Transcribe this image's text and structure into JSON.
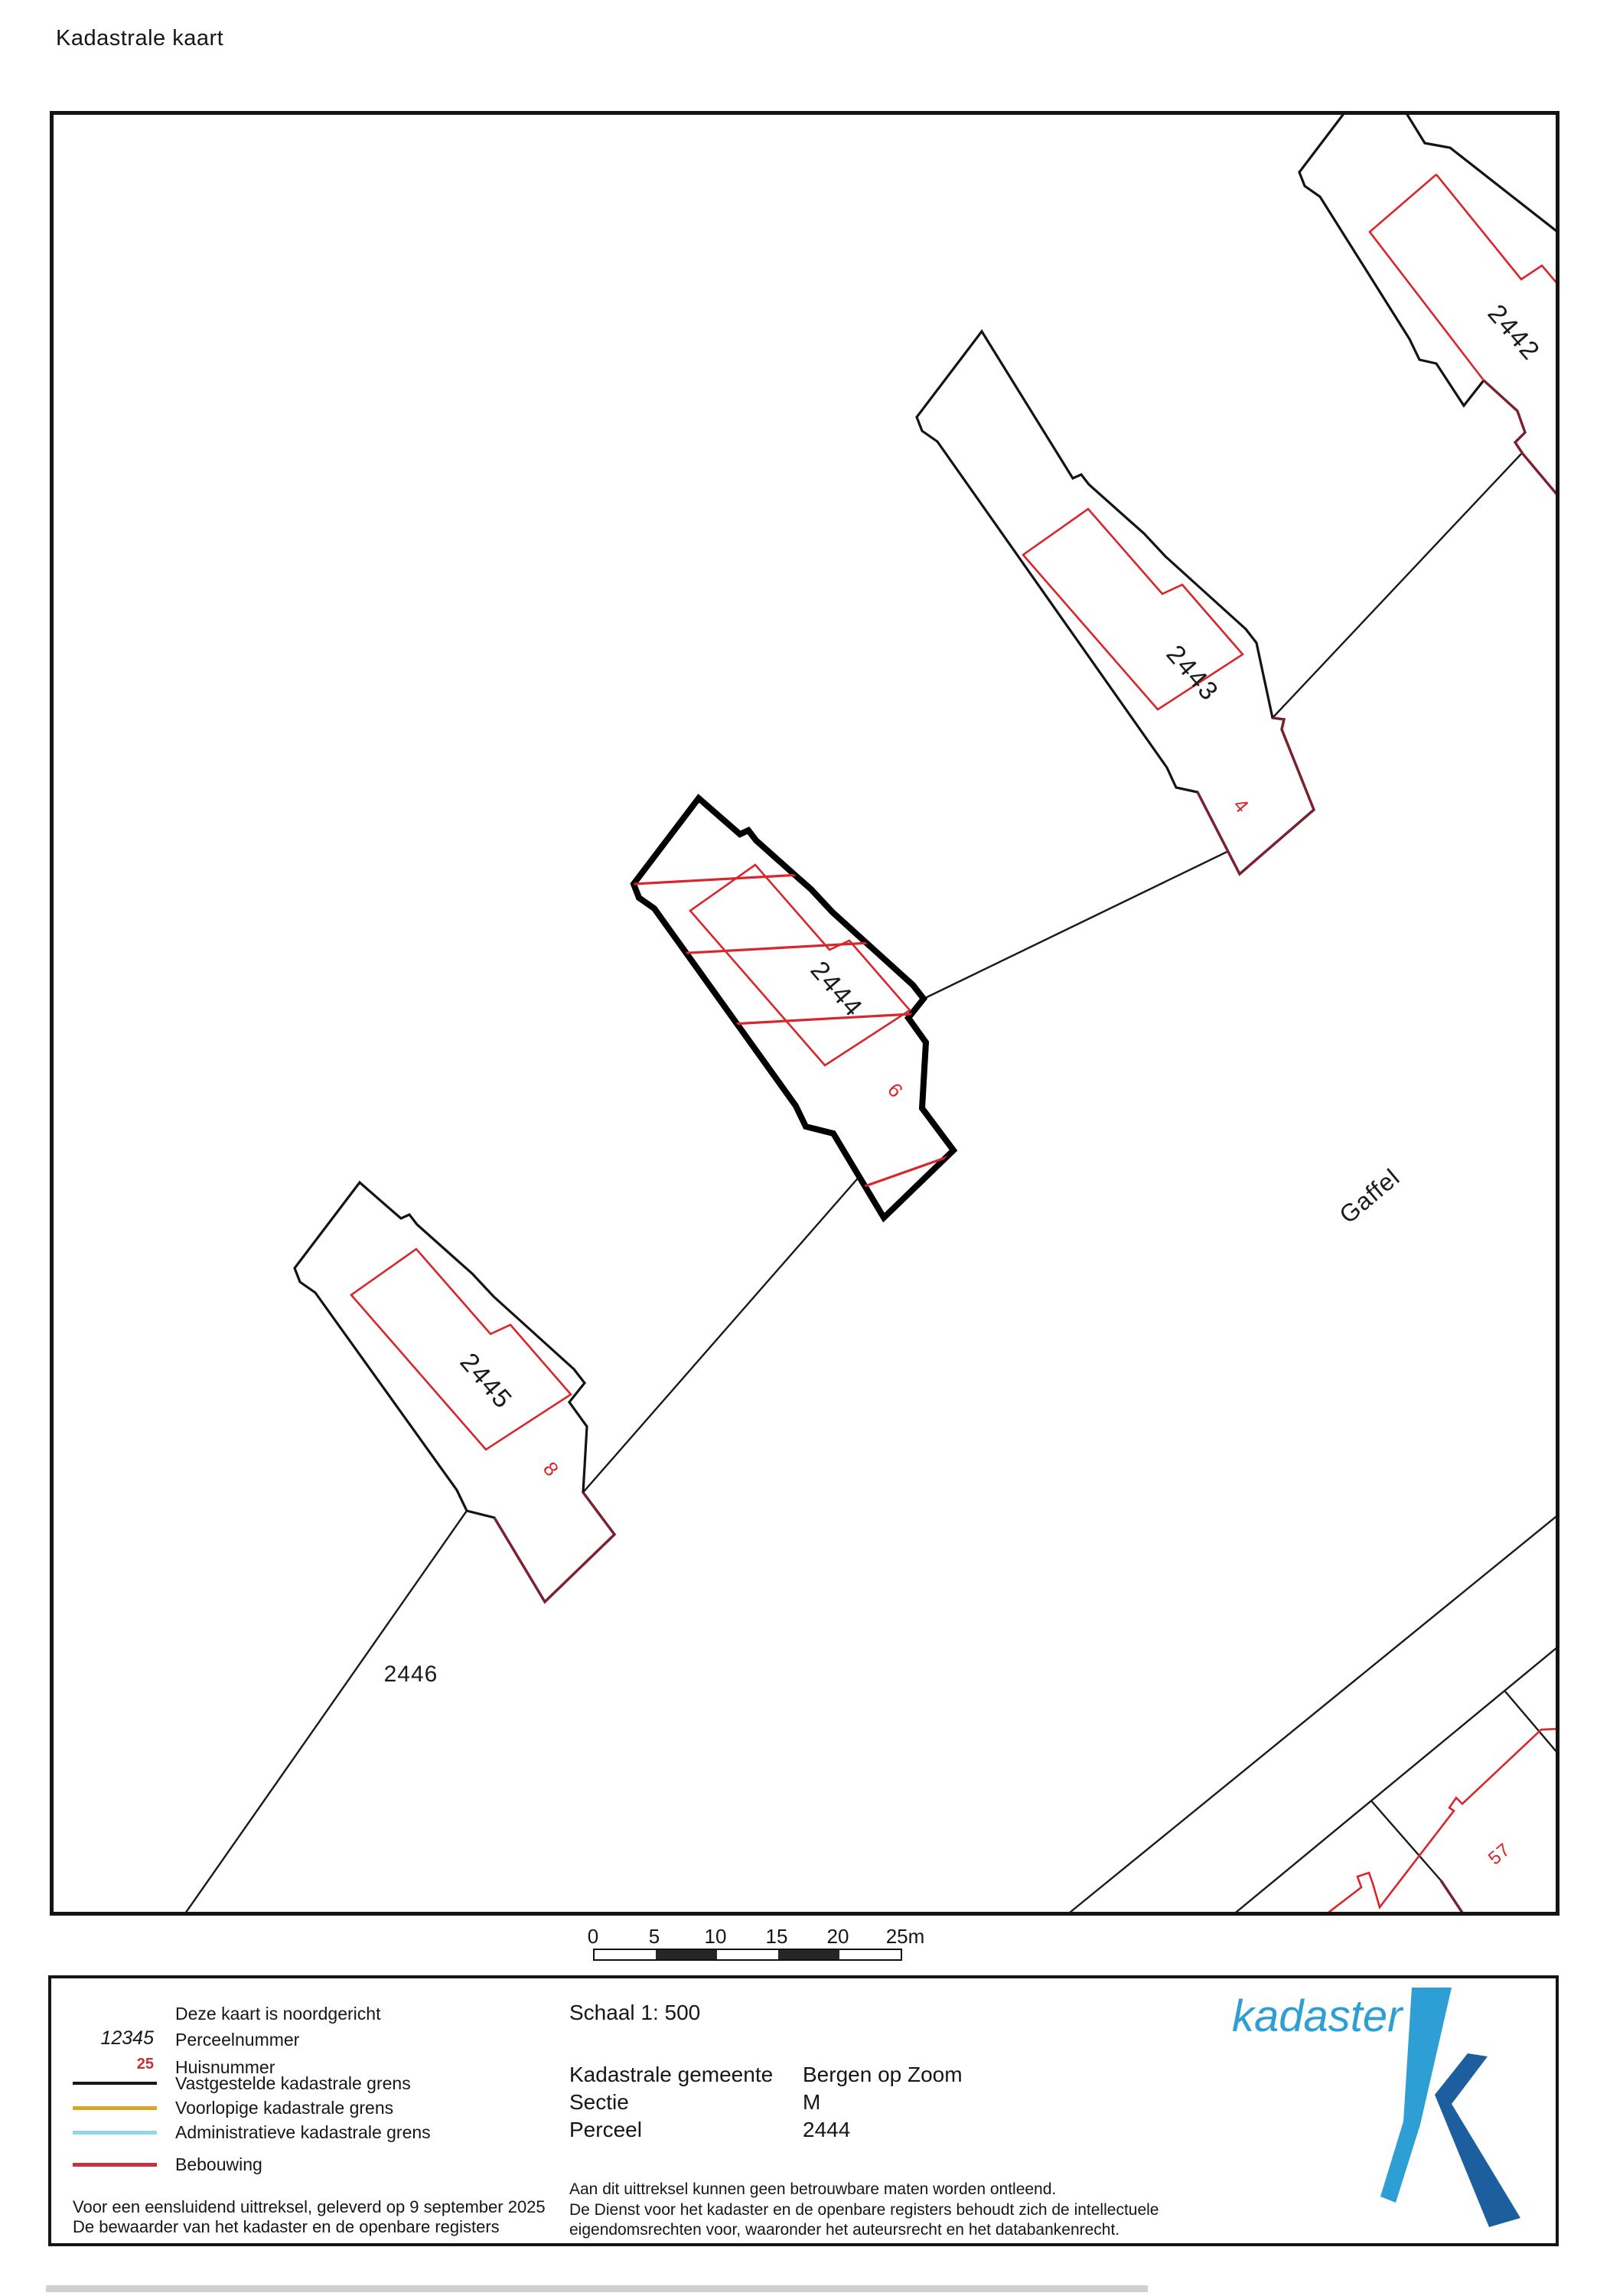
{
  "title": "Kadastrale kaart",
  "map": {
    "parcel_numbers": {
      "p2442": "2442",
      "p2443": "2443",
      "p2444": "2444",
      "p2445": "2445",
      "p2446": "2446"
    },
    "house_numbers": {
      "h4": "4",
      "h6": "6",
      "h8": "8",
      "h57": "57"
    },
    "street": "Gaffel",
    "selected_parcel": "2444",
    "colors": {
      "boundary": "#161616",
      "building": "#d8262c",
      "building_overlap": "#7c2130"
    }
  },
  "scalebar": {
    "ticks": [
      "0",
      "5",
      "10",
      "15",
      "20",
      "25m"
    ]
  },
  "footer": {
    "north_note": "Deze kaart is noordgericht",
    "legend": {
      "items": [
        {
          "symbol": "12345",
          "label": "Perceelnummer"
        },
        {
          "symbol": "25",
          "label": "Huisnummer"
        },
        {
          "label": "Vastgestelde kadastrale grens",
          "color": "#161616"
        },
        {
          "label": "Voorlopige kadastrale grens",
          "color": "#d9a62c"
        },
        {
          "label": "Administratieve kadastrale grens",
          "color": "#8ed9e9"
        },
        {
          "label": "Bebouwing",
          "color": "#c8323e"
        }
      ]
    },
    "delivery_line1": "Voor een eensluidend uittreksel, geleverd op 9 september 2025",
    "delivery_line2": "De bewaarder van het kadaster en de openbare registers",
    "scale_label": "Schaal 1: 500",
    "details": [
      {
        "label": "Kadastrale gemeente",
        "value": "Bergen op Zoom"
      },
      {
        "label": "Sectie",
        "value": "M"
      },
      {
        "label": "Perceel",
        "value": "2444"
      }
    ],
    "disclaimer": [
      "Aan dit uittreksel kunnen geen betrouwbare maten worden ontleend.",
      "De Dienst voor het kadaster en de openbare registers behoudt zich de intellectuele",
      "eigendomsrechten voor, waaronder het auteursrecht en het databankenrecht."
    ],
    "logo_text": "kadaster"
  }
}
